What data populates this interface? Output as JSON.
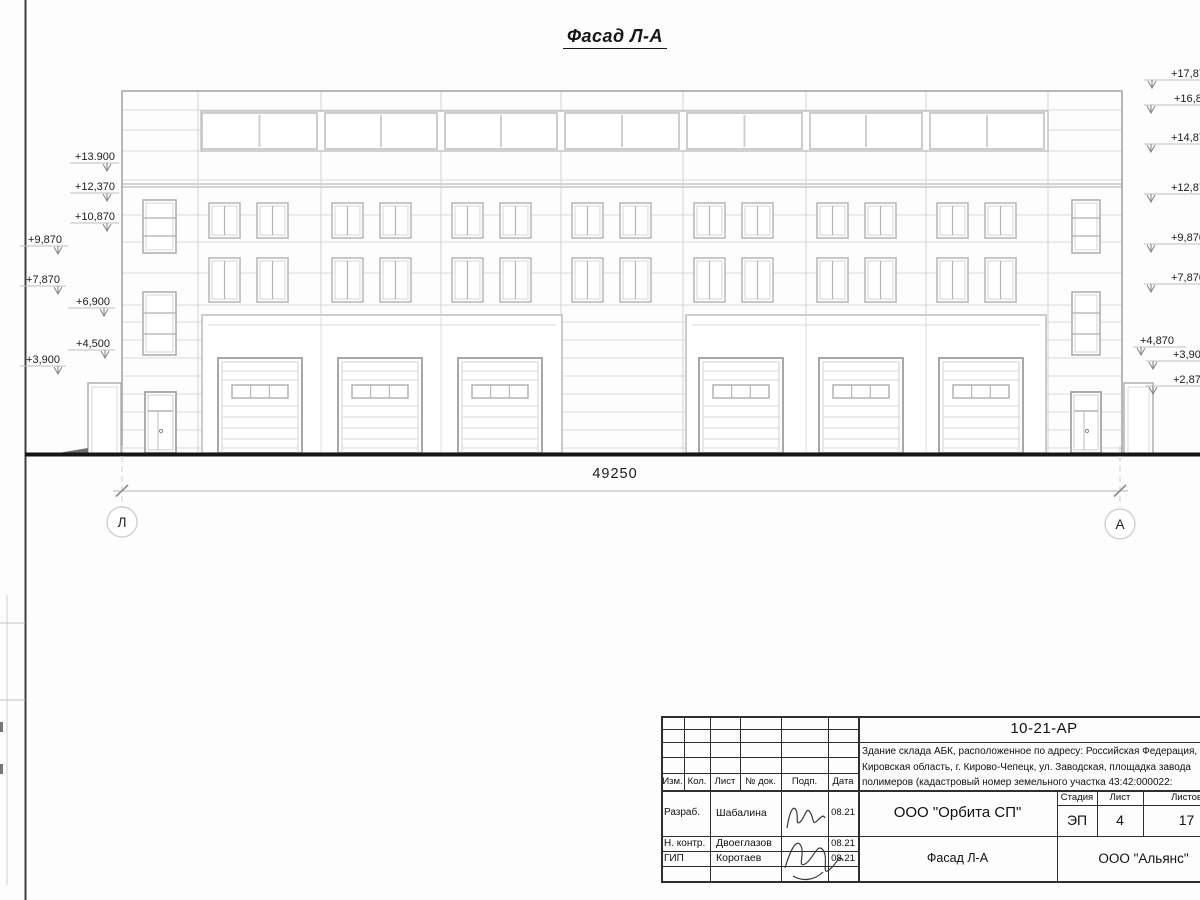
{
  "drawing": {
    "title": "Фасад Л-А",
    "dimension": "49250",
    "axis_left": "Л",
    "axis_right": "А",
    "elevations_left": [
      "+13.900",
      "+12,370",
      "+10,870",
      "+9,870",
      "+7,870",
      "+6,900",
      "+4,500",
      "+3,900"
    ],
    "elevations_right": [
      "+17,870",
      "+16,870",
      "+14,870",
      "+12,870",
      "+9,870",
      "+7,870",
      "+4,870",
      "+3,900",
      "+2,870"
    ]
  },
  "title_block": {
    "doc_code": "10-21-АР",
    "description_lines": [
      "Здание склада АБК, расположенное по адресу: Российская Федерация,",
      "Кировская область, г. Кирово-Чепецк, ул. Заводская, площадка завода",
      "полимеров (кадастровый номер земельного участка 43:42:000022:"
    ],
    "revision_headers": [
      "Изм.",
      "Кол.",
      "Лист",
      "№ док.",
      "Подп.",
      "Дата"
    ],
    "signature_rows": [
      {
        "role": "Разраб.",
        "name": "Шабалина",
        "date": "08.21"
      },
      {
        "role": "Н. контр.",
        "name": "Двоеглазов",
        "date": "08.21"
      },
      {
        "role": "ГИП",
        "name": "Коротаев",
        "date": "08.21"
      }
    ],
    "company": "ООО \"Орбита СП\"",
    "stage_header": "Стадия",
    "sheet_header": "Лист",
    "sheets_header": "Листов",
    "stage": "ЭП",
    "sheet": "4",
    "sheets": "17",
    "sheet_title": "Фасад Л-А",
    "org": "ООО \"Альянс\""
  },
  "colors": {
    "ground": "#161616",
    "frame": "#3f3f3f",
    "line_light": "#d9d9d9",
    "line_mid": "#b5b5b5",
    "text": "#1a1a1a"
  }
}
